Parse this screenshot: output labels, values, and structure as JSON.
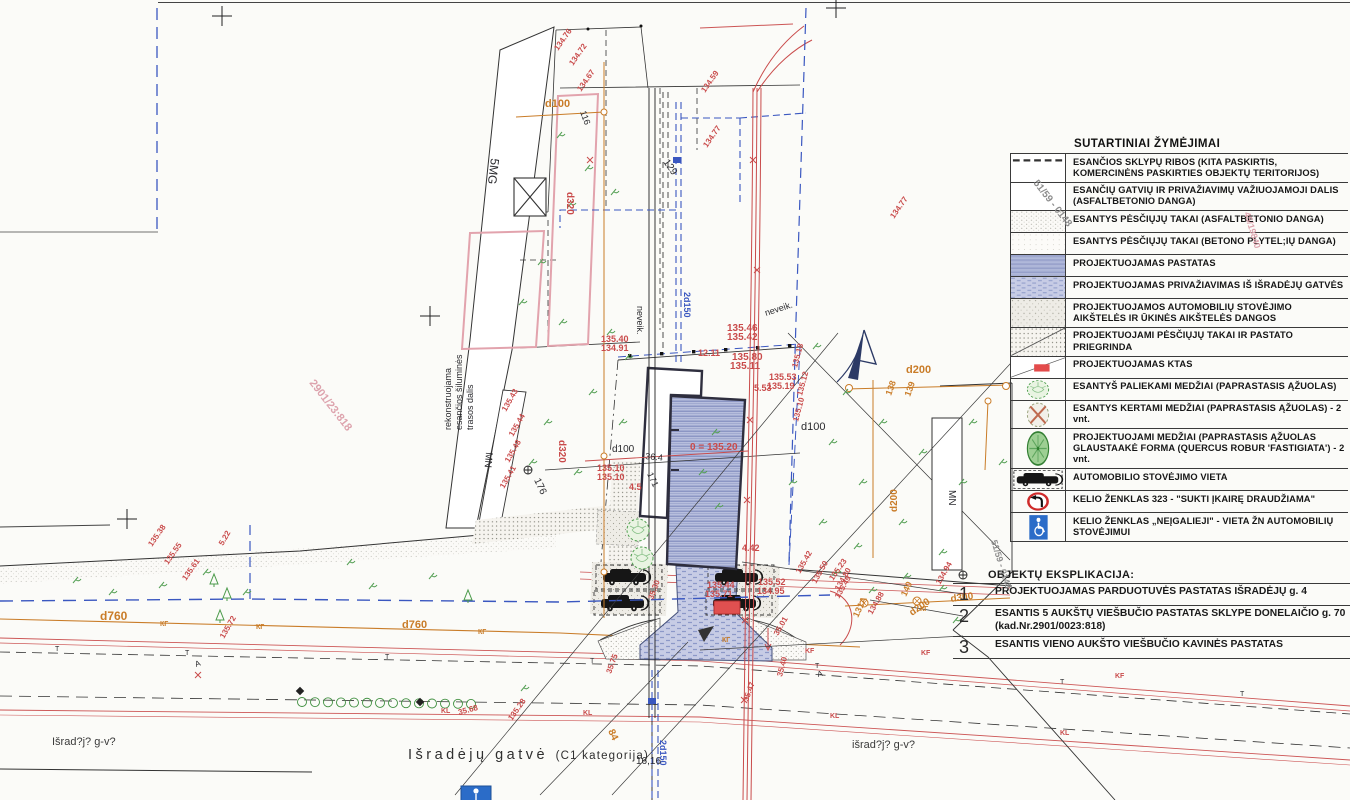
{
  "legend": {
    "title": "SUTARTINIAI ŽYMĖJIMAI",
    "items": [
      {
        "icon": "boundary",
        "label": "ESANČIOS SKLYPŲ RIBOS (KITA PASKIRTIS, KOMERCINĖNS PASKIRTIES OBJEKTŲ TERITORIJOS)"
      },
      {
        "icon": "road-asphalt",
        "label": "ESANČIŲ GATVIŲ IR PRIVAŽIAVIMŲ VAŽIUOJAMOJI DALIS (ASFALTBETONIO DANGA)"
      },
      {
        "icon": "path-asphalt",
        "label": "ESANTYS PĖSČIŲJŲ TAKAI (ASFALTBETONIO DANGA)"
      },
      {
        "icon": "path-concrete",
        "label": "ESANTYS PĖSČIŲJŲ TAKAI (BETONO PLYTEL;IŲ DANGA)"
      },
      {
        "icon": "building-projected",
        "label": "PROJEKTUOJAMAS PASTATAS"
      },
      {
        "icon": "driveway-projected",
        "label": "PROJEKTUOJAMAS PRIVAŽIAVIMAS IŠ IŠRADĖJŲ GATVĖS"
      },
      {
        "icon": "parking-surface",
        "label": "PROJEKTUOJAMOS AUTOMOBILIŲ STOVĖJIMO AIKŠTELĖS IR ŪKINĖS AIKŠTELĖS DANGOS"
      },
      {
        "icon": "footpath-projected",
        "label": "PROJEKTUOJAMI PĖSČIŲJŲ TAKAI IR PASTATO PRIEGRINDA"
      },
      {
        "icon": "ktas-marker",
        "label": "PROJEKTUOJAMAS  KTAS"
      },
      {
        "icon": "tree-existing",
        "label": "ESANTYŠ PALIEKAMI MEDŽIAI (PAPRASTASIS ĄŽUOLAS)"
      },
      {
        "icon": "tree-removed",
        "label": "ESANTYS KERTAMI MEDŽIAI (PAPRASTASIS ĄŽUOLAS) - 2 vnt."
      },
      {
        "icon": "tree-projected",
        "label": "PROJEKTUOJAMI MEDŽIAI (PAPRASTASIS ĄŽUOLAS GLAUSTAAKĖ FORMA (QUERCUS ROBUR 'FASTIGIATA') - 2 vnt."
      },
      {
        "icon": "parking-spot-car",
        "label": "AUTOMOBILIO STOVĖJIMO VIETA"
      },
      {
        "icon": "sign-no-left-turn",
        "label": "KELIO ŽENKLAS 323 - \"SUKTI ĮKAIRĘ DRAUDŽIAMA\""
      },
      {
        "icon": "sign-disabled-parking",
        "label": "KELIO ŽENKLAS „NEĮGALIEJI\" - VIETA ŽN AUTOMOBILIŲ STOVĖJIMUI"
      }
    ]
  },
  "explication": {
    "title": "OBJEKTŲ EKSPLIKACIJA:",
    "items": [
      {
        "no": "1",
        "text": "PROJEKTUOJAMAS PARDUOTUVĖS PASTATAS IŠRADĖJŲ g. 4"
      },
      {
        "no": "2",
        "text": "ESANTIS  5 AUKŠTŲ VIEŠBUČIO PASTATAS SKLYPE DONELAIČIO g. 70 (kad.Nr.2901/0023:818)"
      },
      {
        "no": "3",
        "text": "ESANTIS  VIENO AUKŠTO VIEŠBUČIO KAVINĖS PASTATAS"
      }
    ]
  },
  "street": {
    "name": "Išradėjų gatvė",
    "category": "(C1 kategorija)",
    "left_handwritten": "Išrad?j? g-v?",
    "right_handwritten": "išrad?j? g-v?"
  },
  "colors": {
    "paper": "#fbfbf8",
    "building_fill": "#b7bedd",
    "boundary_blue": "#3a57c0",
    "utility_red": "#c94b4b",
    "utility_orange": "#c97c28",
    "vegetation_green": "#55a055",
    "ktas_red": "#e34b4b",
    "sign_blue": "#2b6cc8"
  },
  "plan_labels": [
    {
      "t": "5MG",
      "x": 491,
      "y": 158,
      "r": 97,
      "c": "black",
      "s": 12
    },
    {
      "t": "MN",
      "x": 486,
      "y": 452,
      "r": 95,
      "c": "black",
      "s": 10
    },
    {
      "t": "MN",
      "x": 949,
      "y": 490,
      "r": 90,
      "c": "black",
      "s": 10
    },
    {
      "t": "rekonstruojama",
      "x": 451,
      "y": 430,
      "r": -90,
      "c": "black",
      "s": 9
    },
    {
      "t": "esančios šiluminės",
      "x": 462,
      "y": 430,
      "r": -90,
      "c": "black",
      "s": 9
    },
    {
      "t": "trasos dalis",
      "x": 473,
      "y": 430,
      "r": -90,
      "c": "black",
      "s": 9
    },
    {
      "t": "neveik.",
      "x": 637,
      "y": 306,
      "r": 90,
      "c": "black",
      "s": 9
    },
    {
      "t": "neveik.",
      "x": 766,
      "y": 316,
      "r": -18,
      "c": "black",
      "s": 9
    },
    {
      "t": "2d150",
      "x": 684,
      "y": 292,
      "r": 90,
      "c": "blue",
      "s": 9
    },
    {
      "t": "2d150",
      "x": 660,
      "y": 740,
      "r": 90,
      "c": "blue",
      "s": 9
    },
    {
      "t": "d100",
      "x": 545,
      "y": 107,
      "r": 0,
      "c": "orange",
      "s": 11
    },
    {
      "t": "d100",
      "x": 612,
      "y": 452,
      "r": 0,
      "c": "black",
      "s": 10
    },
    {
      "t": "36.4",
      "x": 645,
      "y": 459,
      "r": 6,
      "c": "black",
      "s": 9
    },
    {
      "t": "d100",
      "x": 801,
      "y": 430,
      "r": 0,
      "c": "black",
      "s": 11
    },
    {
      "t": "d200",
      "x": 906,
      "y": 373,
      "r": 0,
      "c": "orange",
      "s": 11
    },
    {
      "t": "d200",
      "x": 897,
      "y": 512,
      "r": -90,
      "c": "orange",
      "s": 10
    },
    {
      "t": "d200",
      "x": 912,
      "y": 616,
      "r": -35,
      "c": "orange",
      "s": 10
    },
    {
      "t": "d300",
      "x": 951,
      "y": 602,
      "r": -8,
      "c": "orange",
      "s": 10
    },
    {
      "t": "d320",
      "x": 567,
      "y": 192,
      "r": 90,
      "c": "red",
      "s": 10
    },
    {
      "t": "d320",
      "x": 559,
      "y": 440,
      "r": 90,
      "c": "red",
      "s": 10
    },
    {
      "t": "d760",
      "x": 100,
      "y": 620,
      "r": 0,
      "c": "orange",
      "s": 12
    },
    {
      "t": "d760",
      "x": 402,
      "y": 628,
      "r": 0,
      "c": "orange",
      "s": 11
    },
    {
      "t": "КГ",
      "x": 160,
      "y": 626,
      "r": 0,
      "c": "orange",
      "s": 7
    },
    {
      "t": "КГ",
      "x": 256,
      "y": 629,
      "r": 0,
      "c": "orange",
      "s": 7
    },
    {
      "t": "КГ",
      "x": 478,
      "y": 634,
      "r": 0,
      "c": "orange",
      "s": 7
    },
    {
      "t": "КГ",
      "x": 722,
      "y": 642,
      "r": 0,
      "c": "orange",
      "s": 7
    },
    {
      "t": "КГ",
      "x": 920,
      "y": 611,
      "r": 0,
      "c": "orange",
      "s": 7
    },
    {
      "t": "138",
      "x": 891,
      "y": 396,
      "r": -70,
      "c": "orange",
      "s": 9
    },
    {
      "t": "139",
      "x": 910,
      "y": 397,
      "r": -70,
      "c": "orange",
      "s": 9
    },
    {
      "t": "140",
      "x": 906,
      "y": 597,
      "r": -65,
      "c": "orange",
      "s": 9
    },
    {
      "t": "131A",
      "x": 858,
      "y": 618,
      "r": -65,
      "c": "orange",
      "s": 9
    },
    {
      "t": "84",
      "x": 608,
      "y": 731,
      "r": 65,
      "c": "orange",
      "s": 10
    },
    {
      "t": "116",
      "x": 580,
      "y": 112,
      "r": 70,
      "c": "black",
      "s": 9
    },
    {
      "t": "129",
      "x": 663,
      "y": 162,
      "r": 55,
      "c": "black",
      "s": 10
    },
    {
      "t": "171",
      "x": 647,
      "y": 474,
      "r": 65,
      "c": "black",
      "s": 9
    },
    {
      "t": "176",
      "x": 534,
      "y": 480,
      "r": 65,
      "c": "black",
      "s": 10
    },
    {
      "t": "16,16",
      "x": 636,
      "y": 764,
      "r": 0,
      "c": "black",
      "s": 10
    },
    {
      "t": "T",
      "x": 55,
      "y": 651,
      "r": 0,
      "c": "black",
      "s": 7
    },
    {
      "t": "T",
      "x": 185,
      "y": 655,
      "r": 0,
      "c": "black",
      "s": 7
    },
    {
      "t": "T",
      "x": 385,
      "y": 659,
      "r": 0,
      "c": "black",
      "s": 7
    },
    {
      "t": "T",
      "x": 590,
      "y": 663,
      "r": 0,
      "c": "black",
      "s": 7
    },
    {
      "t": "T",
      "x": 815,
      "y": 668,
      "r": 0,
      "c": "black",
      "s": 7
    },
    {
      "t": "T",
      "x": 1060,
      "y": 684,
      "r": 0,
      "c": "black",
      "s": 7
    },
    {
      "t": "T",
      "x": 1240,
      "y": 696,
      "r": 0,
      "c": "black",
      "s": 7
    },
    {
      "t": "KF",
      "x": 805,
      "y": 653,
      "r": 0,
      "c": "red",
      "s": 7
    },
    {
      "t": "KF",
      "x": 921,
      "y": 655,
      "r": 0,
      "c": "red",
      "s": 7
    },
    {
      "t": "KF",
      "x": 1115,
      "y": 678,
      "r": 0,
      "c": "red",
      "s": 7
    },
    {
      "t": "KL",
      "x": 441,
      "y": 713,
      "r": 0,
      "c": "red",
      "s": 7
    },
    {
      "t": "KL",
      "x": 583,
      "y": 715,
      "r": 0,
      "c": "red",
      "s": 7
    },
    {
      "t": "KL",
      "x": 830,
      "y": 718,
      "r": 0,
      "c": "red",
      "s": 7
    },
    {
      "t": "KL",
      "x": 1060,
      "y": 735,
      "r": 0,
      "c": "red",
      "s": 7
    },
    {
      "t": "A",
      "x": 196,
      "y": 667,
      "r": -20,
      "c": "black",
      "s": 8
    },
    {
      "t": "A",
      "x": 818,
      "y": 677,
      "r": -15,
      "c": "black",
      "s": 8
    },
    {
      "t": "135.40",
      "x": 601,
      "y": 342,
      "r": 0,
      "c": "red",
      "s": 9
    },
    {
      "t": "134.91",
      "x": 601,
      "y": 351,
      "r": 0,
      "c": "red",
      "s": 9
    },
    {
      "t": "135.46",
      "x": 727,
      "y": 331,
      "r": 0,
      "c": "red",
      "s": 10
    },
    {
      "t": "135.42",
      "x": 727,
      "y": 340,
      "r": 0,
      "c": "red",
      "s": 10
    },
    {
      "t": "135.80",
      "x": 732,
      "y": 360,
      "r": 0,
      "c": "red",
      "s": 10
    },
    {
      "t": "135.11",
      "x": 730,
      "y": 369,
      "r": 0,
      "c": "red",
      "s": 10
    },
    {
      "t": "135.53",
      "x": 769,
      "y": 380,
      "r": 0,
      "c": "red",
      "s": 9
    },
    {
      "t": "135.19",
      "x": 767,
      "y": 389,
      "r": 0,
      "c": "red",
      "s": 9
    },
    {
      "t": "12.11",
      "x": 698,
      "y": 356,
      "r": 0,
      "c": "red",
      "s": 9
    },
    {
      "t": "5.53",
      "x": 754,
      "y": 391,
      "r": 0,
      "c": "red",
      "s": 9
    },
    {
      "t": "0 = 135.20",
      "x": 690,
      "y": 450,
      "r": 0,
      "c": "red",
      "s": 10
    },
    {
      "t": "135.10",
      "x": 597,
      "y": 471,
      "r": 0,
      "c": "red",
      "s": 9
    },
    {
      "t": "135.10",
      "x": 597,
      "y": 480,
      "r": 0,
      "c": "red",
      "s": 9
    },
    {
      "t": "4.5",
      "x": 629,
      "y": 490,
      "r": 0,
      "c": "red",
      "s": 9
    },
    {
      "t": "4.42",
      "x": 742,
      "y": 551,
      "r": 0,
      "c": "red",
      "s": 9
    },
    {
      "t": "135.44",
      "x": 707,
      "y": 588,
      "r": 0,
      "c": "red",
      "s": 9
    },
    {
      "t": "135.71",
      "x": 705,
      "y": 597,
      "r": 0,
      "c": "red",
      "s": 9
    },
    {
      "t": "135.52",
      "x": 758,
      "y": 585,
      "r": 0,
      "c": "red",
      "s": 9
    },
    {
      "t": "134.95",
      "x": 757,
      "y": 594,
      "r": 0,
      "c": "red",
      "s": 9
    },
    {
      "t": "134.76",
      "x": 558,
      "y": 51,
      "r": -55,
      "c": "red",
      "s": 8
    },
    {
      "t": "134.72",
      "x": 573,
      "y": 66,
      "r": -55,
      "c": "red",
      "s": 8
    },
    {
      "t": "134.67",
      "x": 581,
      "y": 92,
      "r": -55,
      "c": "red",
      "s": 8
    },
    {
      "t": "134.59",
      "x": 705,
      "y": 93,
      "r": -55,
      "c": "red",
      "s": 8
    },
    {
      "t": "134.77",
      "x": 707,
      "y": 148,
      "r": -55,
      "c": "red",
      "s": 8
    },
    {
      "t": "134.77",
      "x": 894,
      "y": 219,
      "r": -55,
      "c": "red",
      "s": 8
    },
    {
      "t": "135.18",
      "x": 797,
      "y": 368,
      "r": -75,
      "c": "red",
      "s": 8
    },
    {
      "t": "135.12",
      "x": 802,
      "y": 396,
      "r": -75,
      "c": "red",
      "s": 8
    },
    {
      "t": "135.10",
      "x": 798,
      "y": 422,
      "r": -75,
      "c": "red",
      "s": 8
    },
    {
      "t": "135.43",
      "x": 506,
      "y": 412,
      "r": -60,
      "c": "red",
      "s": 8
    },
    {
      "t": "135.44",
      "x": 513,
      "y": 437,
      "r": -60,
      "c": "red",
      "s": 8
    },
    {
      "t": "135.48",
      "x": 509,
      "y": 463,
      "r": -60,
      "c": "red",
      "s": 8
    },
    {
      "t": "135.41",
      "x": 504,
      "y": 489,
      "r": -60,
      "c": "red",
      "s": 8
    },
    {
      "t": "135.38",
      "x": 152,
      "y": 547,
      "r": -55,
      "c": "red",
      "s": 8
    },
    {
      "t": "135.55",
      "x": 168,
      "y": 565,
      "r": -55,
      "c": "red",
      "s": 8
    },
    {
      "t": "135.61",
      "x": 186,
      "y": 581,
      "r": -55,
      "c": "red",
      "s": 8
    },
    {
      "t": "5.22",
      "x": 223,
      "y": 546,
      "r": -60,
      "c": "red",
      "s": 8
    },
    {
      "t": "135.72",
      "x": 224,
      "y": 639,
      "r": -60,
      "c": "red",
      "s": 8
    },
    {
      "t": "135.42",
      "x": 800,
      "y": 574,
      "r": -60,
      "c": "red",
      "s": 8
    },
    {
      "t": "135.50",
      "x": 816,
      "y": 584,
      "r": -60,
      "c": "red",
      "s": 8
    },
    {
      "t": "135.49",
      "x": 839,
      "y": 599,
      "r": -60,
      "c": "red",
      "s": 8
    },
    {
      "t": "35.75",
      "x": 611,
      "y": 674,
      "r": -70,
      "c": "red",
      "s": 8
    },
    {
      "t": "35.01",
      "x": 778,
      "y": 636,
      "r": -60,
      "c": "red",
      "s": 8
    },
    {
      "t": "35.40",
      "x": 782,
      "y": 677,
      "r": -75,
      "c": "red",
      "s": 8
    },
    {
      "t": "35.47",
      "x": 748,
      "y": 702,
      "r": -70,
      "c": "red",
      "s": 8
    },
    {
      "t": "35.30",
      "x": 653,
      "y": 600,
      "r": -70,
      "c": "red",
      "s": 8
    },
    {
      "t": "35.68",
      "x": 459,
      "y": 715,
      "r": -15,
      "c": "red",
      "s": 8
    },
    {
      "t": "135.23",
      "x": 833,
      "y": 581,
      "r": -55,
      "c": "red",
      "s": 8
    },
    {
      "t": "134.80",
      "x": 839,
      "y": 591,
      "r": -60,
      "c": "red",
      "s": 8
    },
    {
      "t": "134.88",
      "x": 872,
      "y": 615,
      "r": -60,
      "c": "red",
      "s": 8
    },
    {
      "t": "134.94",
      "x": 940,
      "y": 585,
      "r": -60,
      "c": "red",
      "s": 8
    },
    {
      "t": "135.28",
      "x": 512,
      "y": 721,
      "r": -55,
      "c": "red",
      "s": 8
    },
    {
      "t": "2901/23:818",
      "x": 309,
      "y": 383,
      "r": 52,
      "c": "pink",
      "s": 11
    },
    {
      "t": "51/59 - 0148",
      "x": 1033,
      "y": 183,
      "r": 52,
      "c": "gray",
      "s": 10,
      "layer": "top"
    },
    {
      "t": "51/59 - 0148",
      "x": 991,
      "y": 541,
      "r": 73,
      "c": "gray",
      "s": 9,
      "layer": "top"
    },
    {
      "t": "45/19840",
      "x": 1244,
      "y": 213,
      "r": 73,
      "c": "pink",
      "s": 9,
      "layer": "top"
    }
  ]
}
